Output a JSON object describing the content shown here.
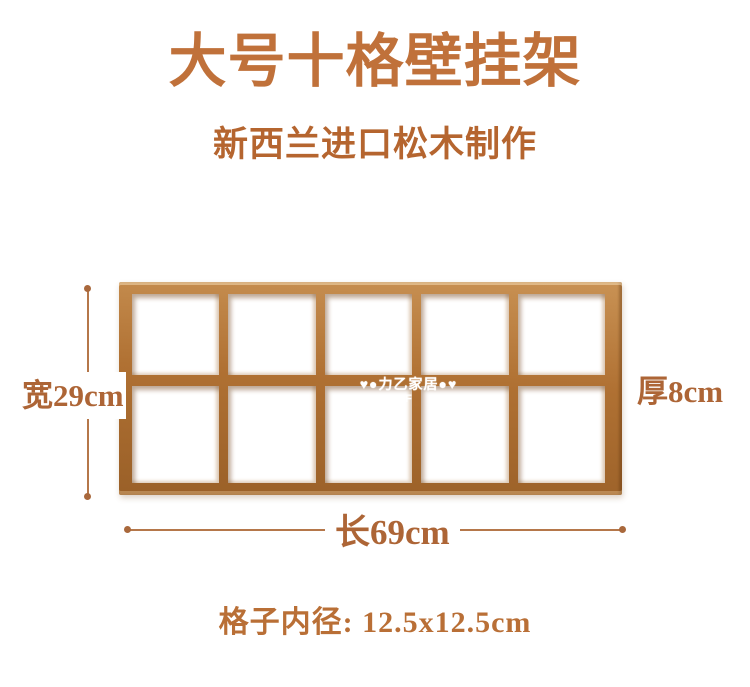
{
  "header": {
    "title": "大号十格壁挂架",
    "subtitle": "新西兰进口松木制作"
  },
  "shelf": {
    "rows": 2,
    "cols": 5,
    "cells": 10
  },
  "watermark": {
    "text": "♥●力乙家居●♥",
    "sub": "F"
  },
  "dimensions": {
    "width_label": "宽29cm",
    "thickness_label": "厚8cm",
    "length_label": "长69cm",
    "cell_inner_label": "格子内径: 12.5x12.5cm"
  },
  "colors": {
    "page_bg": "#ffffff",
    "title_text": "#c0713a",
    "subtitle_text": "#b5652f",
    "label_text": "#ad6536",
    "spec_text": "#b96f36",
    "line": "#b5774a",
    "dot": "#a9683c",
    "wood_light": "#c99254",
    "wood_mid": "#b07133",
    "wood_dark": "#9a6028"
  }
}
